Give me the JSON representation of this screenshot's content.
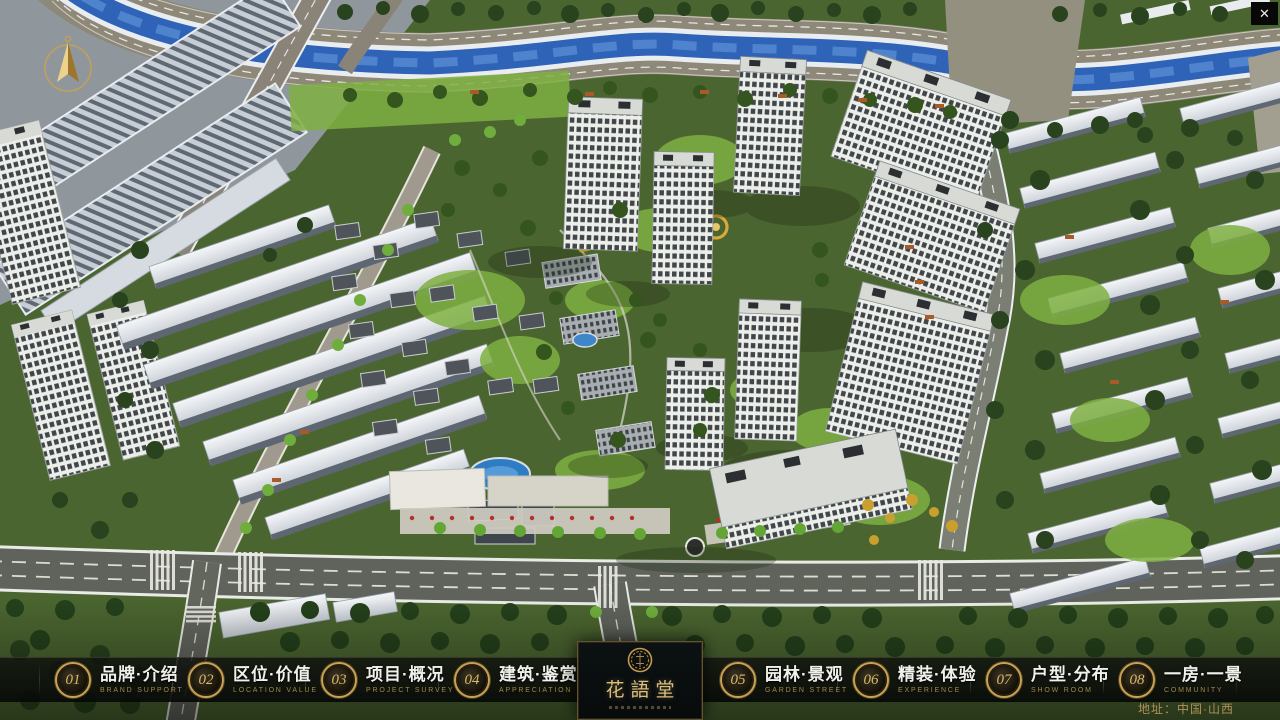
{
  "window": {
    "close_icon": "✕"
  },
  "compass": {
    "icon": "north-arrow"
  },
  "nav": {
    "items": [
      {
        "num": "01",
        "zh": "品牌·介绍",
        "en": "BRAND SUPPORT"
      },
      {
        "num": "02",
        "zh": "区位·价值",
        "en": "LOCATION VALUE"
      },
      {
        "num": "03",
        "zh": "项目·概况",
        "en": "PROJECT SURVEY"
      },
      {
        "num": "04",
        "zh": "建筑·鉴赏",
        "en": "APPRECIATION"
      },
      {
        "num": "05",
        "zh": "园林·景观",
        "en": "GARDEN STREET"
      },
      {
        "num": "06",
        "zh": "精装·体验",
        "en": "EXPERIENCE"
      },
      {
        "num": "07",
        "zh": "户型·分布",
        "en": "SHOW ROOM"
      },
      {
        "num": "08",
        "zh": "一房·一景",
        "en": "COMMUNITY"
      }
    ]
  },
  "logo": {
    "name": "花語堂"
  },
  "footer": {
    "address": "地址：中国·山西"
  },
  "colors": {
    "accent_gold": "#c9a254",
    "nav_text": "#f0f1ec",
    "nav_subtext": "#a3874b",
    "canal_blue": "#2f63b8",
    "address_gold": "#ad9158"
  }
}
